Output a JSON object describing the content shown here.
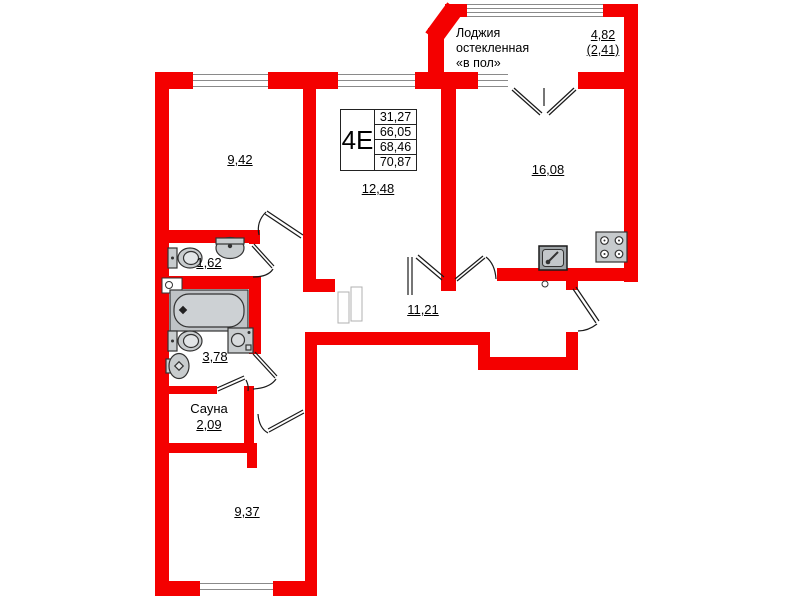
{
  "plan": {
    "title": "Apartment floor plan",
    "unit": {
      "label": "4Е",
      "areas": [
        "31,27",
        "66,05",
        "68,46",
        "70,87"
      ]
    },
    "loggia": {
      "line1": "Лоджия",
      "line2": "остекленная",
      "line3": "«в пол»",
      "area": "4,82",
      "area_reduced": "(2,41)"
    },
    "rooms": {
      "r942": "9,42",
      "r1248": "12,48",
      "r1608": "16,08",
      "r162": "1,62",
      "r378": "3,78",
      "r1121": "11,21",
      "sauna_name": "Сауна",
      "sauna_area": "2,09",
      "r937": "9,37"
    },
    "colors": {
      "wall": "#f40000",
      "fixture_fill": "#c8ccce",
      "fixture_stroke": "#333333",
      "glazing_line": "#8a8a8a",
      "text": "#000000"
    }
  }
}
